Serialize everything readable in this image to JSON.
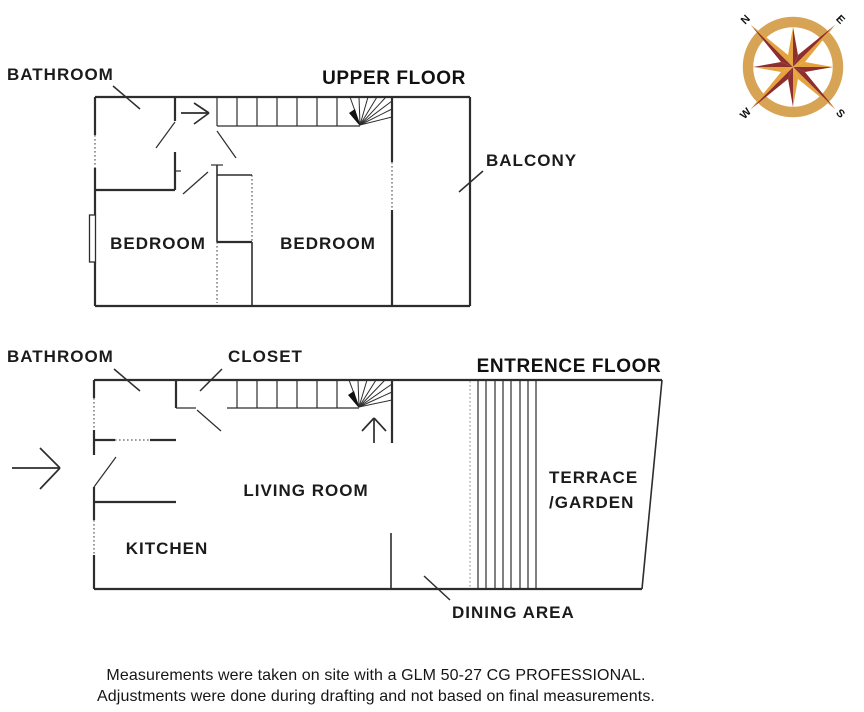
{
  "upper_floor": {
    "title": "UPPER FLOOR",
    "labels": {
      "bathroom": "BATHROOM",
      "balcony": "BALCONY",
      "bedroom_left": "BEDROOM",
      "bedroom_right": "BEDROOM"
    }
  },
  "entrance_floor": {
    "title": "ENTRENCE FLOOR",
    "labels": {
      "bathroom": "BATHROOM",
      "closet": "CLOSET",
      "living_room": "LIVING ROOM",
      "kitchen": "KITCHEN",
      "terrace_line1": "TERRACE",
      "terrace_line2": "/GARDEN",
      "dining_area": "DINING AREA"
    }
  },
  "compass": {
    "n": "N",
    "e": "E",
    "s": "S",
    "w": "W",
    "ring_color": "#d7a455",
    "dark_color": "#8e2f2f",
    "light_color": "#e5a33e"
  },
  "footer": {
    "line1": "Measurements were taken on site with a GLM 50-27 CG PROFESSIONAL.",
    "line2": "Adjustments were done during drafting and not based on final measurements."
  }
}
